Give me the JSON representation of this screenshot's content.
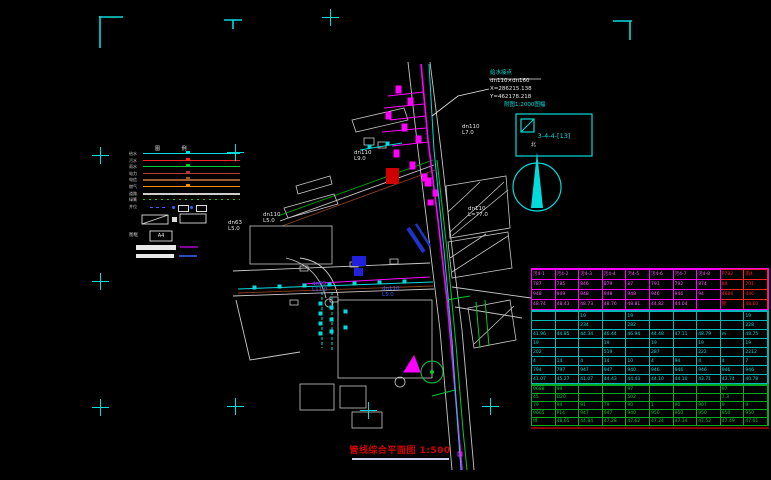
{
  "colors": {
    "bg": "#000000",
    "cyan": "#00dcdc",
    "magenta": "#ff00ff",
    "red": "#ff2222",
    "green": "#00cc33",
    "blue": "#3b62ff",
    "white": "#e8e8e8",
    "orange": "#ff9000",
    "brown": "#8a4020",
    "title_red": "#d40000"
  },
  "legend": {
    "header": "图 例",
    "rows": [
      {
        "label": "给水",
        "color": "#00dcdc",
        "style": "solid"
      },
      {
        "label": "污水",
        "color": "#ff2222",
        "style": "solid"
      },
      {
        "label": "雨水",
        "color": "#00cc33",
        "style": "solid"
      },
      {
        "label": "电力",
        "color": "#b43a3a",
        "style": "solid"
      },
      {
        "label": "电信",
        "color": "#9a5a30",
        "style": "solid"
      },
      {
        "label": "燃气",
        "color": "#ff9000",
        "style": "solid"
      },
      {
        "label": "道路",
        "color": "#cfcfcf",
        "style": "thick"
      },
      {
        "label": "绿篱",
        "color": "#00cc33",
        "style": "dotted"
      },
      {
        "label": "井位",
        "color": "#3b62ff",
        "style": "symbols"
      }
    ],
    "frame_label": "图框",
    "frame_size": "A4"
  },
  "compass": {
    "north_label": "北"
  },
  "index_box": {
    "caption": "附图1:2000图幅",
    "code": "3-4-4-[13]"
  },
  "callout": {
    "lines": [
      {
        "text": "给水接点",
        "color": "#00dcdc"
      },
      {
        "text": "dn110×dn160",
        "color": "#e8e8e8"
      },
      {
        "text": "X=286215.138",
        "color": "#e8e8e8"
      },
      {
        "text": "Y=462178.218",
        "color": "#e8e8e8"
      }
    ]
  },
  "pipe_labels": [
    {
      "text": "dn110\nL7.0",
      "x": 462,
      "y": 124,
      "color": "#e8e8e8",
      "size": 5.5
    },
    {
      "text": "dn110\nL9.0",
      "x": 354,
      "y": 150,
      "color": "#e8e8e8",
      "size": 5.5
    },
    {
      "text": "dn110\nL5.0",
      "x": 263,
      "y": 212,
      "color": "#e8e8e8",
      "size": 5.5
    },
    {
      "text": "dn63\nL5.0",
      "x": 228,
      "y": 220,
      "color": "#e8e8e8",
      "size": 5.5
    },
    {
      "text": "dn63\nL11.0",
      "x": 312,
      "y": 281,
      "color": "#3b62ff",
      "size": 5.5
    },
    {
      "text": "dn110\nL5.0",
      "x": 382,
      "y": 286,
      "color": "#3b62ff",
      "size": 5.5
    },
    {
      "text": "dn110\nL=77.0",
      "x": 468,
      "y": 206,
      "color": "#e8e8e8",
      "size": 5.5
    }
  ],
  "crosses": [
    [
      100,
      155
    ],
    [
      100,
      281
    ],
    [
      100,
      407
    ],
    [
      235,
      152
    ],
    [
      235,
      406
    ],
    [
      490,
      406
    ],
    [
      330,
      17
    ],
    [
      368,
      410
    ]
  ],
  "title": {
    "text": "管线综合平面图 1:500"
  },
  "table": {
    "left": 531,
    "top": 268,
    "width": 238,
    "cols": 10,
    "sections": [
      {
        "name": "sewer-section",
        "color": "#ff55ff",
        "border": "#ff00ff",
        "row_h": 10,
        "red_cols": [
          8,
          9
        ],
        "red_color": "#ff2222",
        "rows": [
          [
            "污4-1",
            "污4-2",
            "污4-3",
            "污4-4",
            "污4-5",
            "污4-6",
            "污4-7",
            "污4-8",
            "P782",
            "雨4"
          ],
          [
            "787",
            "785",
            "846",
            "879",
            "87",
            "791",
            "792",
            "874",
            "84",
            "201"
          ],
          [
            "948",
            "949",
            "948",
            "948",
            "948",
            "946",
            "946",
            "94",
            "4686",
            "446"
          ],
          [
            "48.74",
            "48.43",
            "48.73",
            "48.76",
            "48.81",
            "44.82",
            "44.04",
            "",
            "管",
            "48.60"
          ]
        ]
      },
      {
        "name": "water-section",
        "color": "#00dcdc",
        "border": "#00b8b8",
        "row_h": 9,
        "rows": [
          [
            "",
            "",
            "19",
            "",
            "19",
            "",
            "",
            "",
            "",
            "19"
          ],
          [
            "",
            "",
            "234",
            "",
            "282",
            "",
            "",
            "",
            "",
            "228"
          ],
          [
            "41.96",
            "44.85",
            "44.34",
            "46.44",
            "46.94",
            "44.48",
            "47.11",
            "48.79",
            "m",
            "48.75"
          ],
          [
            "19",
            "",
            "",
            "19",
            "",
            "19",
            "",
            "19",
            "",
            "19"
          ],
          [
            "202",
            "",
            "",
            "519",
            "",
            "287",
            "",
            "222",
            "",
            "2212"
          ],
          [
            "4",
            "14",
            "4",
            "14",
            "10",
            "4",
            "94",
            "4",
            "4",
            "7"
          ],
          [
            "794",
            "797",
            "947",
            "947",
            "940",
            "946",
            "946",
            "946",
            "946",
            "946"
          ],
          [
            "41.07",
            "45.27",
            "41.07",
            "44.43",
            "44.43",
            "44.10",
            "44.10",
            "43.71",
            "43.74",
            "40.78"
          ]
        ]
      },
      {
        "name": "rain-section",
        "color": "#00cc33",
        "border": "#00aa22",
        "row_h": 8,
        "rows": [
          [
            "9688",
            "99",
            "",
            "",
            "97",
            "",
            "",
            "",
            "97",
            ""
          ],
          [
            "45",
            "D20",
            "",
            "",
            "502",
            "",
            "",
            "",
            "7.3",
            ""
          ],
          [
            "79",
            "94",
            "91",
            "79",
            "90",
            "1",
            "90",
            "907",
            "9",
            "9"
          ],
          [
            "9005",
            "P14",
            "947",
            "947",
            "940",
            "950",
            "950",
            "950",
            "950",
            "950"
          ],
          [
            "绿",
            "48.65",
            "44.84",
            "47.28",
            "47.62",
            "47.24",
            "47.34",
            "47.52",
            "47.49",
            "47.61"
          ]
        ]
      }
    ]
  }
}
